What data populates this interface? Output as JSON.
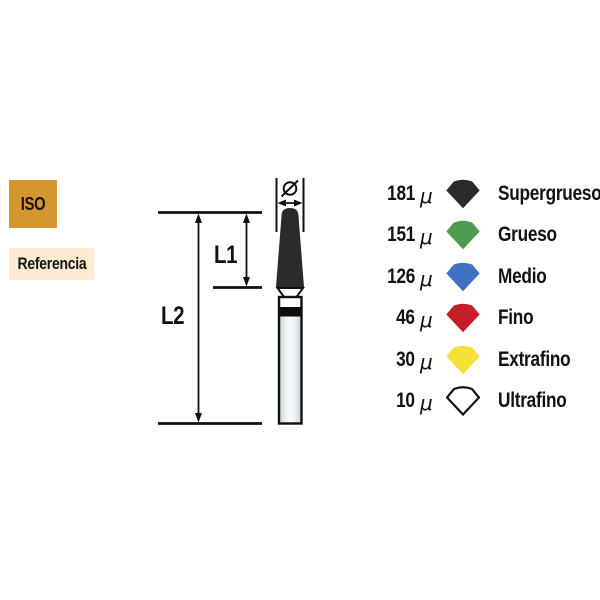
{
  "badges": {
    "iso": "ISO",
    "referencia": "Referencia"
  },
  "diagram": {
    "diameter_symbol": "Ø",
    "l1_label": "L1",
    "l2_label": "L2"
  },
  "legend": {
    "rows": [
      {
        "value": "181",
        "unit": "μ",
        "label": "Supergrueso",
        "color": "#2a2a26",
        "outline": false
      },
      {
        "value": "151",
        "unit": "μ",
        "label": "Grueso",
        "color": "#4e9b4f",
        "outline": false
      },
      {
        "value": "126",
        "unit": "μ",
        "label": "Medio",
        "color": "#3e71c1",
        "outline": false
      },
      {
        "value": "46",
        "unit": "μ",
        "label": "Fino",
        "color": "#c41f28",
        "outline": false
      },
      {
        "value": "30",
        "unit": "μ",
        "label": "Extrafino",
        "color": "#f5e135",
        "outline": false
      },
      {
        "value": "10",
        "unit": "μ",
        "label": "Ultrafino",
        "color": "#ffffff",
        "outline": true
      }
    ]
  },
  "colors": {
    "iso_badge_bg": "#d6962f",
    "referencia_badge_bg": "#faebd2",
    "ink": "#111111",
    "bur_head": "#2b2b2b",
    "shank_band": "#0d0d0d"
  }
}
